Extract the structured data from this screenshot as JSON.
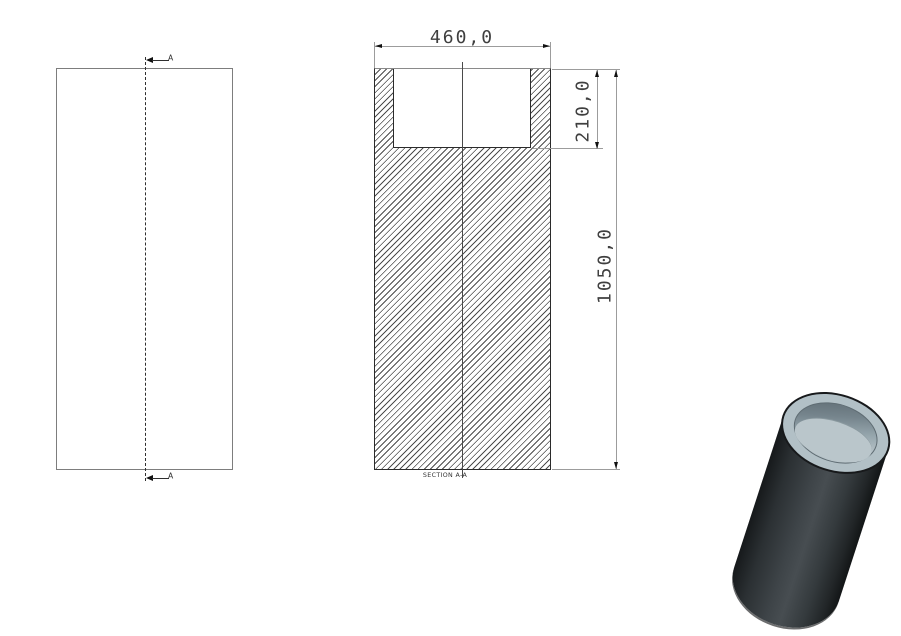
{
  "front_view": {
    "section_marker_top": "A",
    "section_marker_bottom": "A"
  },
  "section_view": {
    "label": "SECTION A-A",
    "dims": {
      "width": "460,0",
      "bore_depth": "210,0",
      "length": "1050,0"
    }
  },
  "colors": {
    "outline_dark": "#2b2b2b",
    "outline_gray": "#7d7d7d",
    "dim_line": "#9c9c9c",
    "dim_text": "#3f3f3f",
    "hatch_line": "#4d4d4d",
    "body_dark": "#16191b",
    "body_light": "#474d51",
    "rim_light": "#b2c0c6",
    "bore_shadow": "#75848c",
    "bore_floor": "#bac6cb"
  }
}
